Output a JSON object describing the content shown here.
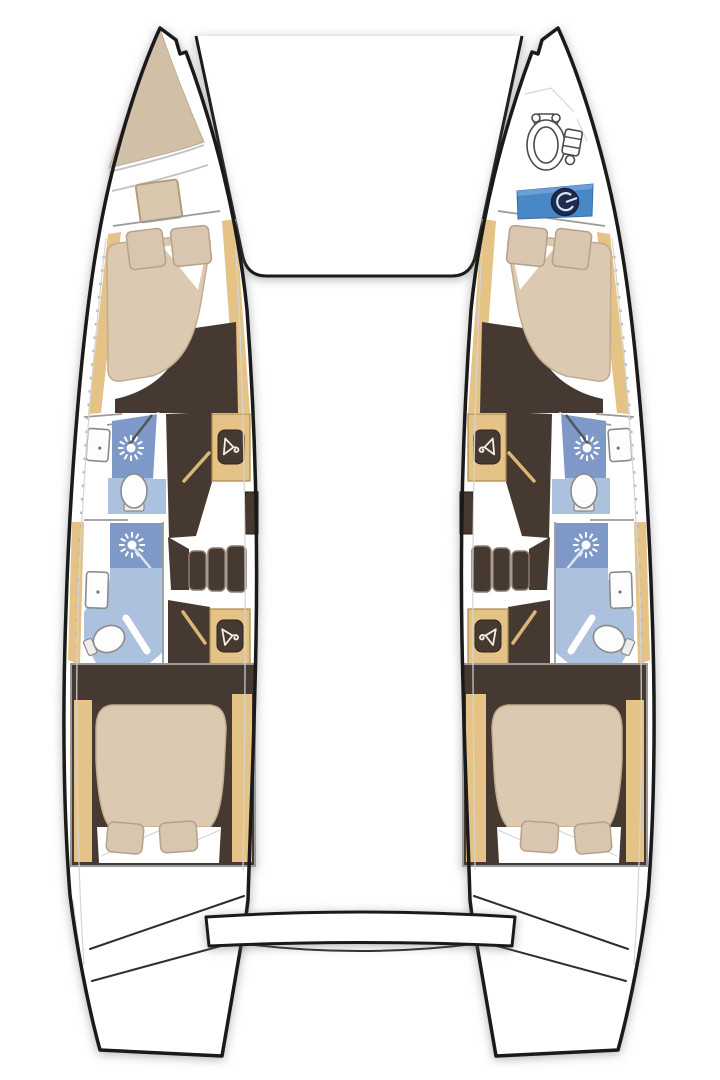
{
  "page": {
    "background": "#ffffff"
  },
  "colors": {
    "hullOutline": "#1a1a1a",
    "hullFill": "#ffffff",
    "bowTan": "#d2bfa7",
    "wood": "#e5c286",
    "woodEdge": "#b08e4f",
    "darkFloor": "#463931",
    "showerBlue": "#7e99c8",
    "bathFloorBlue": "#abc1de",
    "mattress": "#dcc9b2",
    "pillow": "#d9c6b1",
    "pillowEdge": "#b7a189",
    "sheetWhite": "#ffffff",
    "logoPanelBlue": "#4a87c7",
    "logoNavy": "#1d2c4e",
    "wallGray": "#9a9a9a",
    "stepEdge": "#8a7a6c",
    "doorTan": "#d9b777"
  },
  "plan": {
    "type": "catamaran-floor-plan-top-view",
    "orientation": "bow-up",
    "hulls": [
      {
        "id": "left-hull",
        "features_top_to_bottom": [
          "bow-locker",
          "bow-hatch",
          "forward-double-bed",
          "forward-bathroom-shower",
          "wardrobe",
          "companionway-steps",
          "aft-bathroom-shower",
          "wardrobe",
          "aft-double-bed",
          "transom-steps"
        ]
      },
      {
        "id": "right-hull",
        "features_top_to_bottom": [
          "anchor-windlass",
          "brand-badge",
          "forward-double-bed",
          "forward-bathroom-shower",
          "wardrobe",
          "companionway-steps",
          "aft-bathroom-shower",
          "wardrobe",
          "aft-double-bed",
          "transom-steps"
        ]
      }
    ],
    "between_hulls": [
      "foredeck-bridge",
      "aft-platform"
    ],
    "icons": [
      "shower-head-icon",
      "clothes-hanger-icon",
      "toilet-icon",
      "sink-icon",
      "windlass-icon",
      "brand-logo-icon"
    ],
    "counts": {
      "cabins": 4,
      "bathrooms": 4,
      "wardrobes": 4,
      "shower_heads": 4,
      "toilets": 4,
      "sinks": 4,
      "pillows": 8,
      "companionway_steps": 2
    }
  }
}
